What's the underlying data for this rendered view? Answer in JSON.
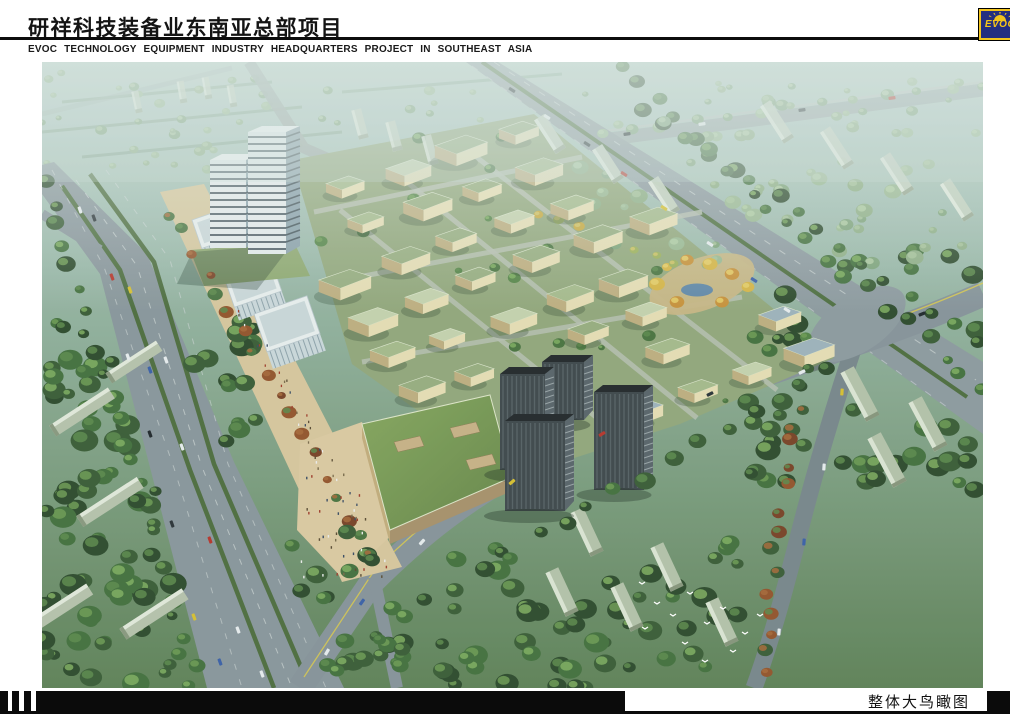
{
  "header": {
    "title_cn": "研祥科技装备业东南亚总部项目",
    "title_en": "EVOC TECHNOLOGY EQUIPMENT INDUSTRY HEADQUARTERS PROJECT IN SOUTHEAST ASIA",
    "logo_text": "EVOC"
  },
  "footer": {
    "caption": "整体大鸟瞰图"
  },
  "colors": {
    "rule_black": "#0d0d0d",
    "logo_navy": "#232e80",
    "logo_yellow": "#f2c41c"
  }
}
